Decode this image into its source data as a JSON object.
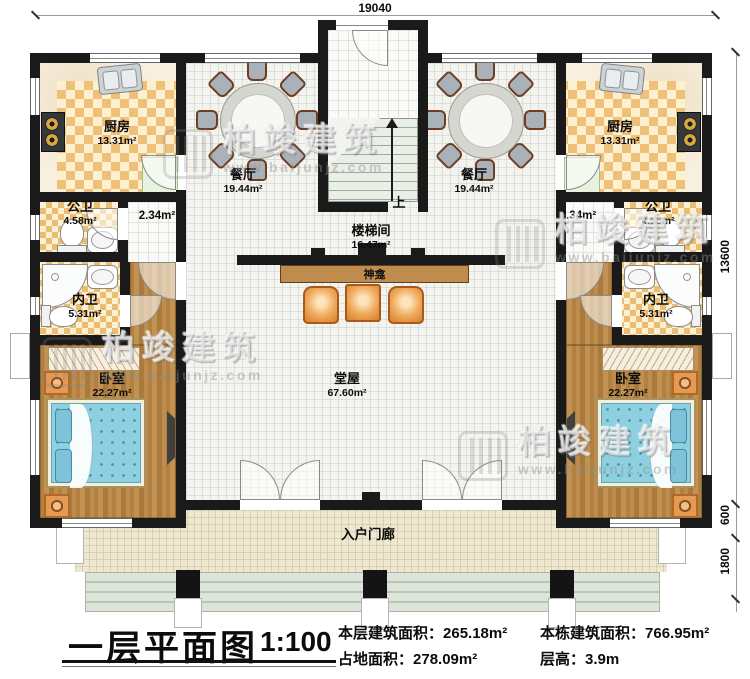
{
  "title_block": {
    "title": "一层平面图",
    "scale": "1:100",
    "stats": [
      {
        "label": "本层建筑面积：",
        "value": "265.18m²"
      },
      {
        "label": "占地面积：",
        "value": "278.09m²"
      },
      {
        "label": "本栋建筑面积：",
        "value": "766.95m²"
      },
      {
        "label": "层高：",
        "value": "3.9m"
      }
    ]
  },
  "dimensions": {
    "top_width": "19040",
    "right_house_depth": "13600",
    "right_porch_depth": "600",
    "right_steps_depth": "1800"
  },
  "rooms": {
    "kitchen": {
      "name": "厨房",
      "area": "13.31m²"
    },
    "dining": {
      "name": "餐厅",
      "area": "19.44m²"
    },
    "public_bath": {
      "name": "公卫",
      "area": "4.58m²"
    },
    "private_bath": {
      "name": "内卫",
      "area": "5.31m²"
    },
    "bedroom": {
      "name": "卧室",
      "area": "22.27m²"
    },
    "stairwell": {
      "name": "楼梯间",
      "area": "16.47m²"
    },
    "hall": {
      "name": "堂屋",
      "area": "67.60m²"
    },
    "side_corridor": {
      "area": "2.34m²"
    },
    "porch": {
      "name": "入户门廊"
    },
    "shrine": {
      "name": "神龛"
    },
    "stairs_up_label": "上"
  },
  "watermark": {
    "brand": "柏竣建筑",
    "url": "www.baijunjz.com"
  },
  "colors": {
    "wall": "#1a1a1a",
    "kitchen_checker": "#efc077",
    "bath_checker": "#eabd72",
    "wood_floor": "#b5854a",
    "tile_floor": "#f3f3f0",
    "porch_floor": "#eee8d0",
    "bed_blue": "#8ed0e0",
    "furniture_orange": "#e89a4e",
    "shrine_brown": "#c08c4e",
    "steps_green": "#ccd6ca"
  }
}
